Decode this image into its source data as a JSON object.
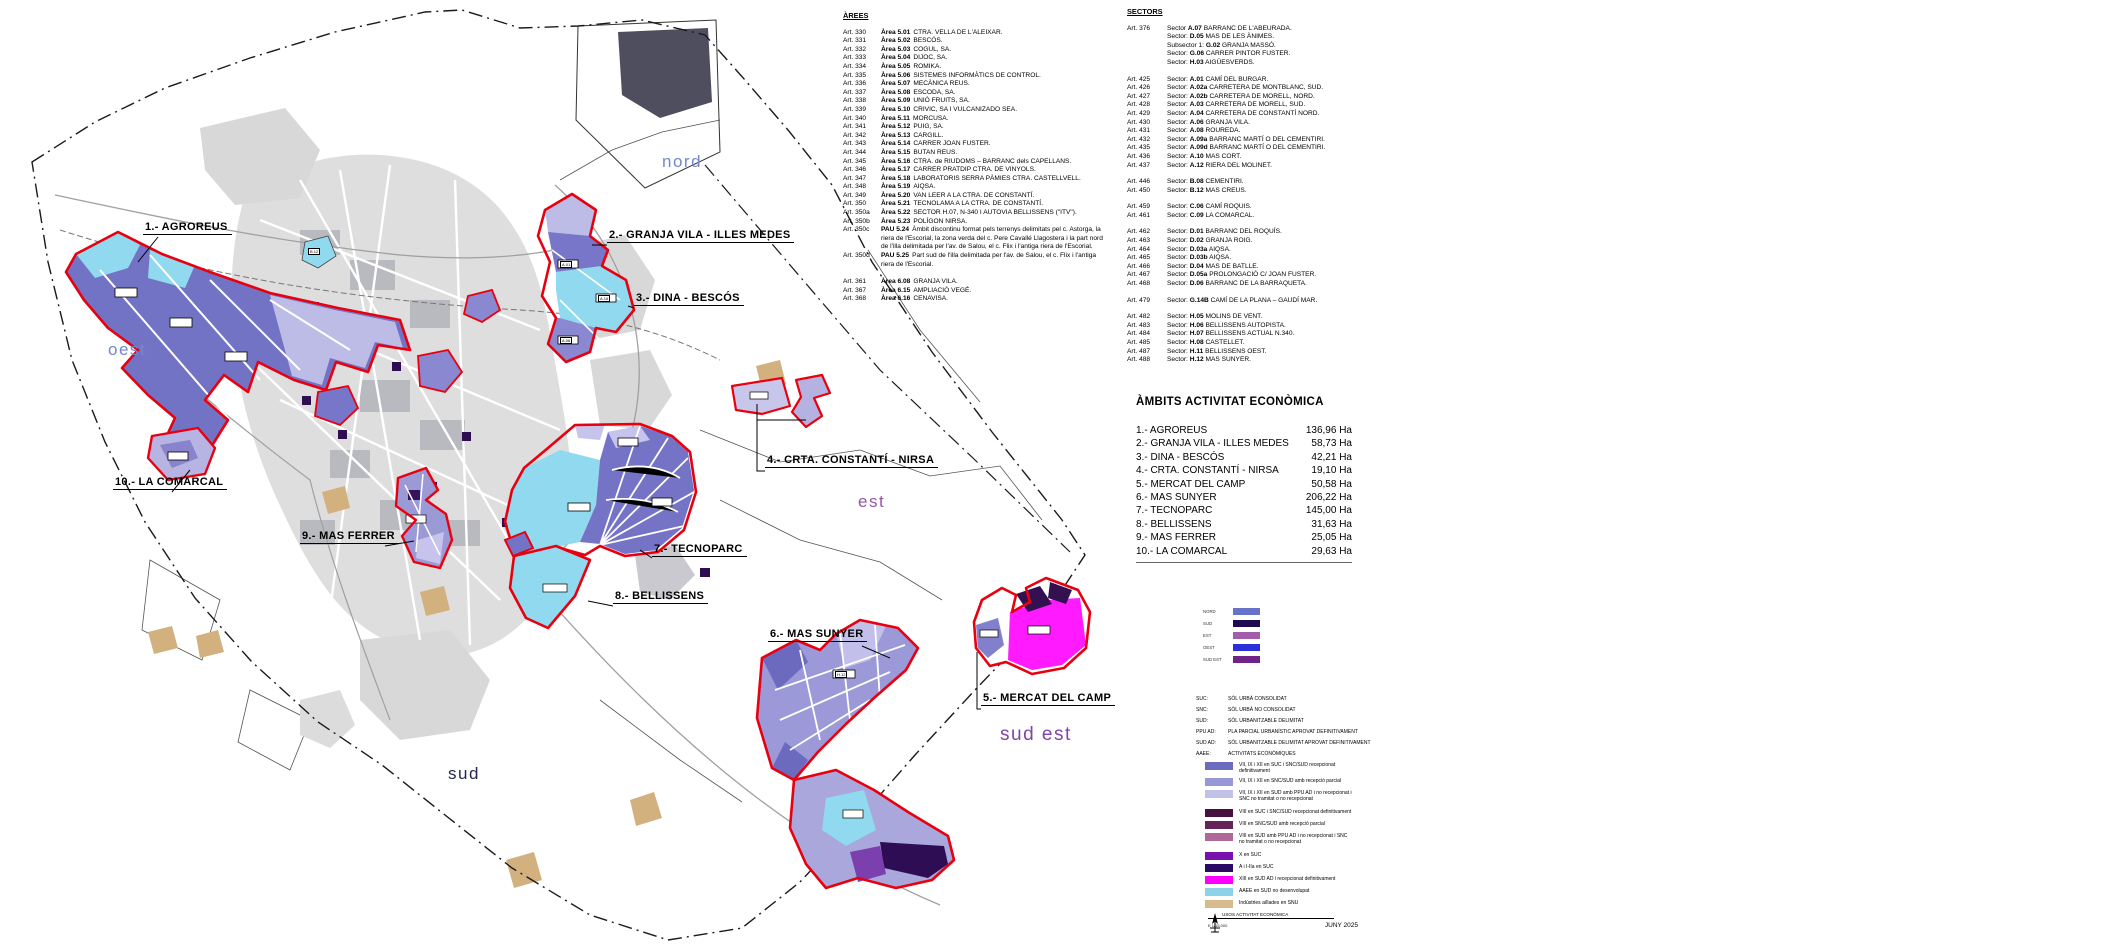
{
  "map": {
    "direction_labels": {
      "nord": "nord",
      "oest": "oest",
      "est": "est",
      "sud": "sud",
      "sud_est": "sud est"
    },
    "zone_labels": [
      "1.- AGROREUS",
      "2.- GRANJA VILA - ILLES MEDES",
      "3.- DINA - BESCÓS",
      "4.- CRTA. CONSTANTÍ - NIRSA",
      "5.- MERCAT DEL CAMP",
      "6.- MAS SUNYER",
      "7.- TECNOPARC",
      "8.- BELLISSENS",
      "9.- MAS FERRER",
      "10.- LA COMARCAL"
    ],
    "parcel_codes": [
      "B.12",
      "A.01",
      "A.16",
      "A.06",
      "H.12"
    ]
  },
  "arees": {
    "title": "ÀREES",
    "items": [
      {
        "art": "Art. 330",
        "code": "Àrea 5.01",
        "name": "CTRA. VELLA DE L'ALEIXAR."
      },
      {
        "art": "Art. 331",
        "code": "Àrea 5.02",
        "name": "BESCÓS."
      },
      {
        "art": "Art. 332",
        "code": "Àrea 5.03",
        "name": "COGUL, SA."
      },
      {
        "art": "Art. 333",
        "code": "Àrea 5.04",
        "name": "DIJOC, SA."
      },
      {
        "art": "Art. 334",
        "code": "Àrea 5.05",
        "name": "ROMIKA."
      },
      {
        "art": "Art. 335",
        "code": "Àrea 5.06",
        "name": "SISTEMES INFORMÀTICS DE CONTROL."
      },
      {
        "art": "Art. 336",
        "code": "Àrea 5.07",
        "name": "MECÀNICA REUS."
      },
      {
        "art": "Art. 337",
        "code": "Àrea 5.08",
        "name": "ESCODA, SA."
      },
      {
        "art": "Art. 338",
        "code": "Àrea 5.09",
        "name": "UNIÓ FRUITS, SA."
      },
      {
        "art": "Art. 339",
        "code": "Àrea 5.10",
        "name": "CRIVIC, SA I VULCANIZADO SEA."
      },
      {
        "art": "Art. 340",
        "code": "Àrea 5.11",
        "name": "MORCUSA."
      },
      {
        "art": "Art. 341",
        "code": "Àrea 5.12",
        "name": "PUIG, SA."
      },
      {
        "art": "Art. 342",
        "code": "Àrea 5.13",
        "name": "CARGILL."
      },
      {
        "art": "Art. 343",
        "code": "Àrea 5.14",
        "name": "CARRER JOAN FUSTER."
      },
      {
        "art": "Art. 344",
        "code": "Àrea 5.15",
        "name": "BUTAN REUS."
      },
      {
        "art": "Art. 345",
        "code": "Àrea 5.16",
        "name": "CTRA. de RIUDOMS – BARRANC dels CAPELLANS."
      },
      {
        "art": "Art. 346",
        "code": "Àrea 5.17",
        "name": "CARRER PRATDIP CTRA. DE VINYOLS."
      },
      {
        "art": "Art. 347",
        "code": "Àrea 5.18",
        "name": "LABORATORIS SERRA PÀMIES CTRA. CASTELLVELL."
      },
      {
        "art": "Art. 348",
        "code": "Àrea 5.19",
        "name": "AIQSA."
      },
      {
        "art": "Art. 349",
        "code": "Àrea 5.20",
        "name": "VAN LEER A LA CTRA. DE CONSTANTÍ."
      },
      {
        "art": "Art. 350",
        "code": "Àrea 5.21",
        "name": "TECNOLAMA A LA CTRA. DE CONSTANTÍ."
      },
      {
        "art": "Art. 350a",
        "code": "Àrea 5.22",
        "name": "SECTOR H.07, N-340 I AUTOVIA BELLISSENS (\"ITV\")."
      },
      {
        "art": "Art. 350b",
        "code": "Àrea 5.23",
        "name": "POLÍGON NIRSA."
      },
      {
        "art": "Art. 350c",
        "code": "PAU 5.24",
        "name": "Àmbit discontinu format pels terrenys delimitats pel c. Astorga, la riera de l'Escorial, la zona verda del c. Pere Cavallé Llagostera i la part nord de l'illa delimitada per l'av. de Salou, el c. Flix i l'antiga riera de l'Escorial."
      },
      {
        "art": "Art. 350d",
        "code": "PAU 5.25",
        "name": "Part sud de l'illa delimitada per l'av. de Salou, el c. Flix i l'antiga riera de l'Escorial."
      },
      {
        "art": "Art. 361",
        "code": "Àrea 6.08",
        "name": "GRANJA VILA.",
        "gap": "gap"
      },
      {
        "art": "Art. 367",
        "code": "Àrea 6.15",
        "name": "AMPLIACIÓ VEGÉ."
      },
      {
        "art": "Art. 368",
        "code": "Àrea 6.16",
        "name": "CENAVISA."
      }
    ]
  },
  "sectors": {
    "title": "SECTORS",
    "items": [
      {
        "art": "Art. 376",
        "label": "Sector",
        "code": "A.07",
        "name": "BARRANC DE L'ABEURADA."
      },
      {
        "art": "",
        "label": "Sector:",
        "code": "D.05",
        "name": "MAS DE LES ÀNIMES."
      },
      {
        "art": "",
        "label": "Subsector 1:",
        "code": "G.02",
        "name": "GRANJA MASSÓ."
      },
      {
        "art": "",
        "label": "Sector:",
        "code": "G.06",
        "name": "CARRER PINTOR FUSTER."
      },
      {
        "art": "",
        "label": "Sector:",
        "code": "H.03",
        "name": "AIGÜESVERDS."
      },
      {
        "art": "Art. 425",
        "label": "Sector:",
        "code": "A.01",
        "name": "CAMÍ DEL BURGAR.",
        "gap": "gap"
      },
      {
        "art": "Art. 426",
        "label": "Sector:",
        "code": "A.02a",
        "name": "CARRETERA DE MONTBLANC, SUD."
      },
      {
        "art": "Art. 427",
        "label": "Sector:",
        "code": "A.02b",
        "name": "CARRETERA DE MORELL, NORD."
      },
      {
        "art": "Art. 428",
        "label": "Sector:",
        "code": "A.03",
        "name": "CARRETERA DE MORELL, SUD."
      },
      {
        "art": "Art. 429",
        "label": "Sector:",
        "code": "A.04",
        "name": "CARRETERA DE CONSTANTÍ NORD."
      },
      {
        "art": "Art. 430",
        "label": "Sector:",
        "code": "A.06",
        "name": "GRANJA VILA."
      },
      {
        "art": "Art. 431",
        "label": "Sector:",
        "code": "A.08",
        "name": "ROUREDA."
      },
      {
        "art": "Art. 432",
        "label": "Sector:",
        "code": "A.09a",
        "name": "BARRANC MARTÍ O DEL CEMENTIRI."
      },
      {
        "art": "Art. 435",
        "label": "Sector:",
        "code": "A.09d",
        "name": "BARRANC MARTÍ O DEL CEMENTIRI."
      },
      {
        "art": "Art. 436",
        "label": "Sector:",
        "code": "A.10",
        "name": "MAS CORT."
      },
      {
        "art": "Art. 437",
        "label": "Sector:",
        "code": "A.12",
        "name": "RIERA DEL MOLINET."
      },
      {
        "art": "Art. 446",
        "label": "Sector:",
        "code": "B.08",
        "name": "CEMENTIRI.",
        "gap": "gap"
      },
      {
        "art": "Art. 450",
        "label": "Sector:",
        "code": "B.12",
        "name": "MAS CREUS."
      },
      {
        "art": "Art. 459",
        "label": "Sector:",
        "code": "C.06",
        "name": "CAMÍ ROQUIS.",
        "gap": "gap"
      },
      {
        "art": "Art. 461",
        "label": "Sector:",
        "code": "C.09",
        "name": "LA COMARCAL."
      },
      {
        "art": "Art. 462",
        "label": "Sector:",
        "code": "D.01",
        "name": "BARRANC DEL ROQUÍS.",
        "gap": "gap"
      },
      {
        "art": "Art. 463",
        "label": "Sector:",
        "code": "D.02",
        "name": "GRANJA ROIG."
      },
      {
        "art": "Art. 464",
        "label": "Sector:",
        "code": "D.03a",
        "name": "AIQSA."
      },
      {
        "art": "Art. 465",
        "label": "Sector:",
        "code": "D.03b",
        "name": "AIQSA."
      },
      {
        "art": "Art. 466",
        "label": "Sector:",
        "code": "D.04",
        "name": "MAS DE BATLLE."
      },
      {
        "art": "Art. 467",
        "label": "Sector:",
        "code": "D.05a",
        "name": "PROLONGACIÓ C/ JOAN FUSTER."
      },
      {
        "art": "Art. 468",
        "label": "Sector:",
        "code": "D.06",
        "name": "BARRANC DE LA BARRAQUETA."
      },
      {
        "art": "Art. 479",
        "label": "Sector:",
        "code": "G.14B",
        "name": "CAMÍ DE LA PLANA – GAUDÍ MAR.",
        "gap": "gap"
      },
      {
        "art": "Art. 482",
        "label": "Sector:",
        "code": "H.05",
        "name": "MOLINS DE VENT.",
        "gap": "gap"
      },
      {
        "art": "Art. 483",
        "label": "Sector:",
        "code": "H.06",
        "name": "BELLISSENS AUTOPISTA."
      },
      {
        "art": "Art. 484",
        "label": "Sector:",
        "code": "H.07",
        "name": "BELLISSENS ACTUAL N.340."
      },
      {
        "art": "Art. 485",
        "label": "Sector:",
        "code": "H.08",
        "name": "CASTELLET."
      },
      {
        "art": "Art. 487",
        "label": "Sector:",
        "code": "H.11",
        "name": "BELLISSENS OEST."
      },
      {
        "art": "Art. 488",
        "label": "Sector:",
        "code": "H.12",
        "name": "MAS SUNYER."
      }
    ]
  },
  "ambits": {
    "title": "ÀMBITS ACTIVITAT ECONÒMICA",
    "rows": [
      {
        "name": "1.- AGROREUS",
        "area": "136,96 Ha"
      },
      {
        "name": "2.- GRANJA VILA - ILLES MEDES",
        "area": "58,73 Ha"
      },
      {
        "name": "3.- DINA - BESCÓS",
        "area": "42,21 Ha"
      },
      {
        "name": "4.- CRTA. CONSTANTÍ - NIRSA",
        "area": "19,10 Ha"
      },
      {
        "name": "5.- MERCAT DEL CAMP",
        "area": "50,58 Ha"
      },
      {
        "name": "6.- MAS SUNYER",
        "area": "206,22 Ha"
      },
      {
        "name": "7.- TECNOPARC",
        "area": "145,00 Ha"
      },
      {
        "name": "8.- BELLISSENS",
        "area": "31,63 Ha"
      },
      {
        "name": "9.- MAS FERRER",
        "area": "25,05 Ha"
      },
      {
        "name": "10.- LA COMARCAL",
        "area": "29,63 Ha"
      }
    ]
  },
  "zones_legend": [
    {
      "label": "NORD",
      "color": "#6673c8"
    },
    {
      "label": "SUD",
      "color": "#1e0a50"
    },
    {
      "label": "EST",
      "color": "#a35cab"
    },
    {
      "label": "OEST",
      "color": "#2b2fd8"
    },
    {
      "label": "SUD EST",
      "color": "#6f2386"
    }
  ],
  "abbreviations": [
    {
      "abbr": "SUC:",
      "text": "SÒL URBÀ CONSOLIDAT"
    },
    {
      "abbr": "SNC:",
      "text": "SÒL URBÀ NO CONSOLIDAT"
    },
    {
      "abbr": "SUD:",
      "text": "SÒL URBANITZABLE DELIMITAT"
    },
    {
      "abbr": "PPU AD:",
      "text": "PLA PARCIAL URBANÍSTIC APROVAT DEFINITIVAMENT"
    },
    {
      "abbr": "SUD AD:",
      "text": "SÒL URBANITZABLE DELIMITAT APROVAT DEFINITIVAMENT"
    },
    {
      "abbr": "AAEE:",
      "text": "ACTIVITATS ECONÒMIQUES"
    }
  ],
  "class_legend": [
    {
      "color": "#6b6bc0",
      "text": "VII, IX i XII en SUC i SNC/SUD recepcionat definitivament"
    },
    {
      "color": "#9898d8",
      "text": "VII, IX i XII en SNC/SUD amb recepció parcial"
    },
    {
      "color": "#c2c2e8",
      "text": "VII, IX i XII en SUD amb PPU AD i no recepcionat i SNC no tramitat o no recepcionat"
    },
    {
      "color": "#46103f",
      "text": "VIII en SUC i SNC/SUD recepcionat definitivament",
      "gap": "gap"
    },
    {
      "color": "#642458",
      "text": "VIII en SNC/SUD amb recepció parcial"
    },
    {
      "color": "#b06898",
      "text": "VIII en SUD amb PPU AD i no recepcionat i SNC no tramitat o no recepcionat"
    },
    {
      "color": "#7a0fb0",
      "text": "X en SUC",
      "gap": "gap"
    },
    {
      "color": "#2a0a62",
      "text": "A i I-IIa en SUC"
    },
    {
      "color": "#ff00ff",
      "text": "XIII en SUD AD i recepcionat definitivament"
    },
    {
      "color": "#8ed2ea",
      "text": "AAEE en SUD no desenvolupat"
    },
    {
      "color": "#d8bb8d",
      "text": "Indústries aïllades en SNU"
    }
  ],
  "footer": {
    "title": "USOS ACTIVITAT ECONÒMICA",
    "scale": "E 1/15.000",
    "date": "JUNY 2025"
  }
}
